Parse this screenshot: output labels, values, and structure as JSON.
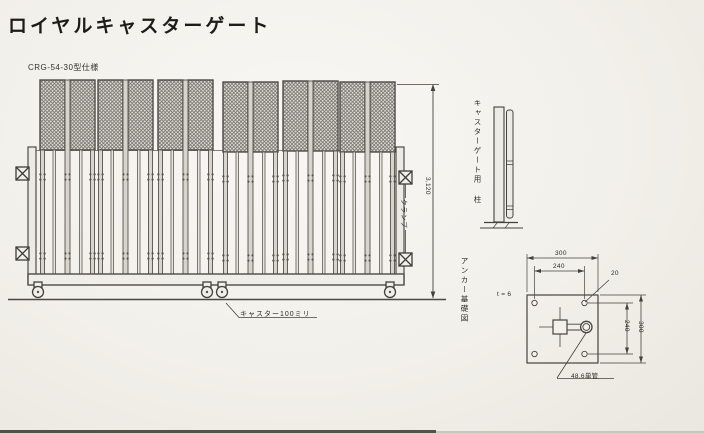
{
  "page": {
    "title": "ロイヤルキャスターゲート",
    "model_label": "CRG-54-30型仕様"
  },
  "gate_view": {
    "height_dim": "3,120",
    "clamp_label": "クランプ",
    "caster_label": "キャスター100ミリ"
  },
  "post_view": {
    "label": "キャスターゲート用 柱"
  },
  "anchor_view": {
    "label": "アンカー基礎図",
    "thickness_label": "t = 6",
    "plate_width_dim": "300",
    "hole_span_dim": "240",
    "hole_dia_dim": "20",
    "hole_span_v_dim": "240",
    "plate_height_dim": "300",
    "pipe_label": "48.6単管"
  },
  "colors": {
    "paper": "#f2f0ea",
    "ink": "#45433f",
    "mesh_line": "#73716c",
    "bar_fill": "#d7d4cd"
  }
}
